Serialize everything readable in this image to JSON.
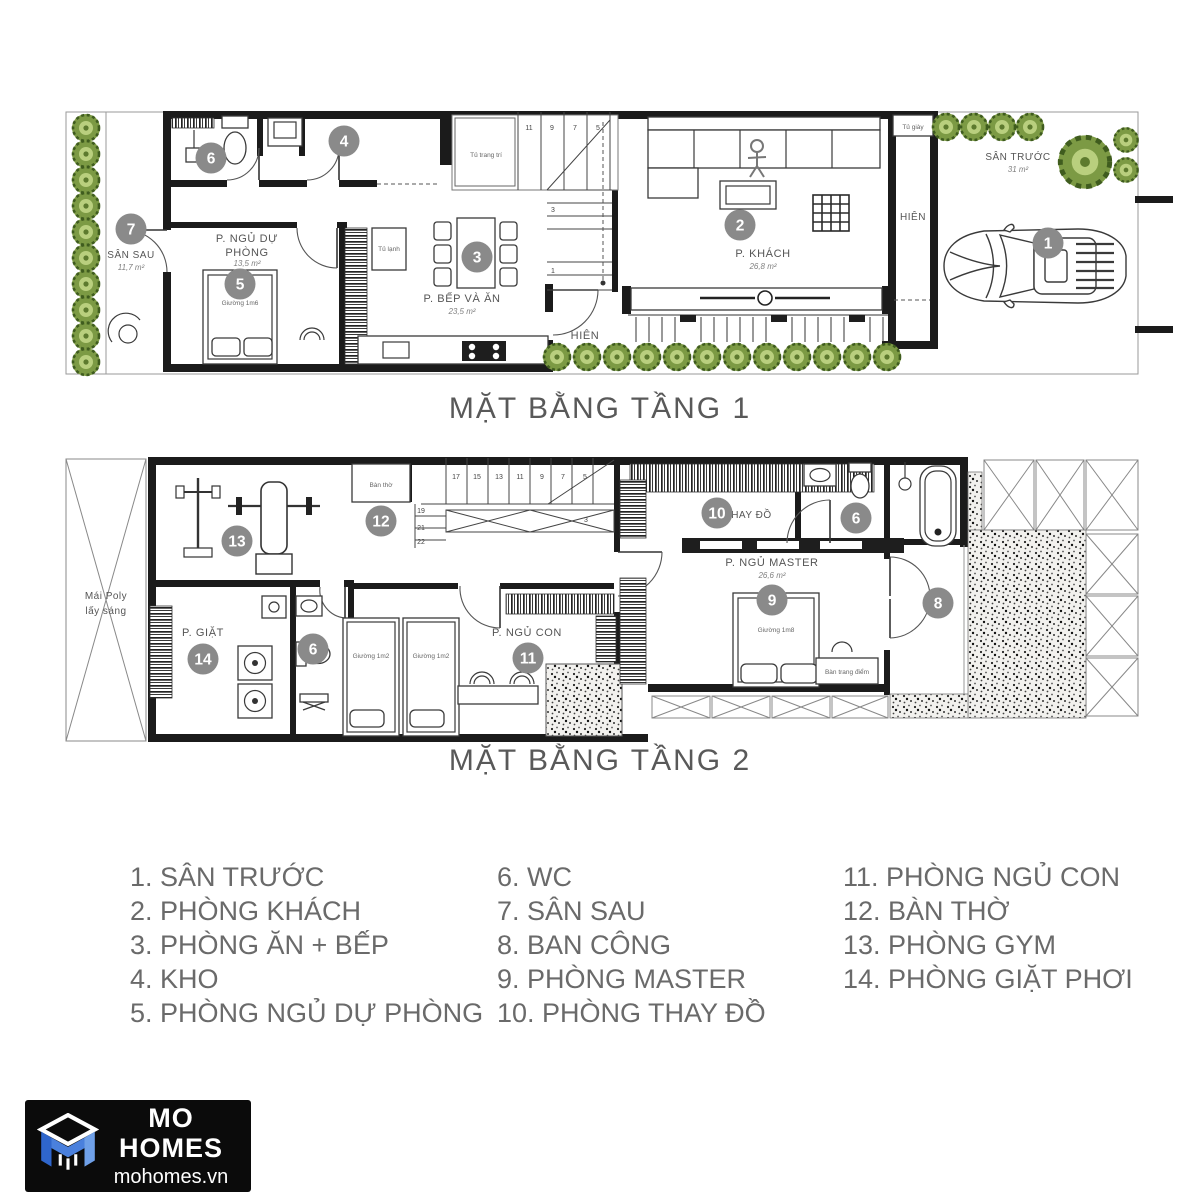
{
  "floor1": {
    "title": "MẶT BẰNG TẦNG 1",
    "rooms": {
      "san_sau": {
        "name": "SÂN SAU",
        "area": "11,7 m²",
        "marker": "7"
      },
      "ngu_du_phong": {
        "name_line1": "P. NGỦ DỰ",
        "name_line2": "PHÒNG",
        "area": "13,5 m²",
        "marker": "5"
      },
      "bep_va_an": {
        "name": "P. BẾP VÀ ĂN",
        "area": "23,5 m²",
        "marker": "3"
      },
      "khach": {
        "name": "P. KHÁCH",
        "area": "26,8 m²",
        "marker": "2"
      },
      "san_truoc": {
        "name": "SÂN TRƯỚC",
        "area": "31 m²",
        "marker": "1"
      },
      "kho": {
        "marker": "4"
      },
      "wc": {
        "marker": "6"
      }
    },
    "labels": {
      "giuong_1m6": "Giường 1m6",
      "tu_lanh": "Tủ lạnh",
      "tu_trang_tri": "Tủ trang trí",
      "tu_giay": "Tủ giày",
      "hien_front": "HIÊN",
      "hien_side": "HIÊN"
    },
    "stairs": {
      "s11": "11",
      "s9": "9",
      "s7": "7",
      "s5": "5",
      "s3": "3",
      "s1": "1"
    }
  },
  "floor2": {
    "title": "MẶT BẰNG TẦNG 2",
    "rooms": {
      "gym": {
        "marker": "13"
      },
      "ban_tho": {
        "name": "Bàn thờ",
        "marker": "12"
      },
      "giat": {
        "name": "P. GIẶT",
        "marker": "14"
      },
      "wc_small": {
        "marker": "6"
      },
      "ngu_con": {
        "name": "P. NGỦ CON",
        "marker": "11"
      },
      "thay_do": {
        "name": "P. THAY ĐỒ",
        "marker": "10"
      },
      "ngu_master": {
        "name": "P. NGỦ MASTER",
        "area": "26,6 m²",
        "marker": "9"
      },
      "wc_master": {
        "marker": "6"
      },
      "ban_cong": {
        "marker": "8"
      }
    },
    "labels": {
      "mai_poly_line1": "Mái Poly",
      "mai_poly_line2": "lấy sáng",
      "giuong_1m2_left": "Giường 1m2",
      "giuong_1m2_right": "Giường 1m2",
      "giuong_1m8": "Giường 1m8",
      "ban_trang_diem": "Bàn trang điểm"
    },
    "stairs": {
      "s17": "17",
      "s15": "15",
      "s13": "13",
      "s11": "11",
      "s9": "9",
      "s7": "7",
      "s5": "5",
      "s3": "3",
      "s19": "19",
      "s21": "21",
      "s22": "22"
    }
  },
  "legend": {
    "columns": [
      [
        "1. SÂN TRƯỚC",
        "2. PHÒNG KHÁCH",
        "3. PHÒNG ĂN + BẾP",
        "4. KHO",
        "5. PHÒNG NGỦ DỰ PHÒNG"
      ],
      [
        "6. WC",
        "7. SÂN SAU",
        "8. BAN CÔNG",
        "9. PHÒNG MASTER",
        "10. PHÒNG THAY ĐỒ"
      ],
      [
        "11. PHÒNG NGỦ CON",
        "12. BÀN THỜ",
        "13. PHÒNG GYM",
        "14. PHÒNG GIẶT PHƠI"
      ]
    ]
  },
  "logo": {
    "brand": "MO HOMES",
    "website": "mohomes.vn"
  },
  "colors": {
    "wall": "#1b1b1b",
    "marker_gray": "#8a8a8a",
    "plan_text": "#555555",
    "legend_text": "#6a6a6a",
    "title_text": "#595959",
    "plant_green": "#7c9a44",
    "logo_blue": "#3f6fd1",
    "logo_bg": "#0b0b0b"
  }
}
